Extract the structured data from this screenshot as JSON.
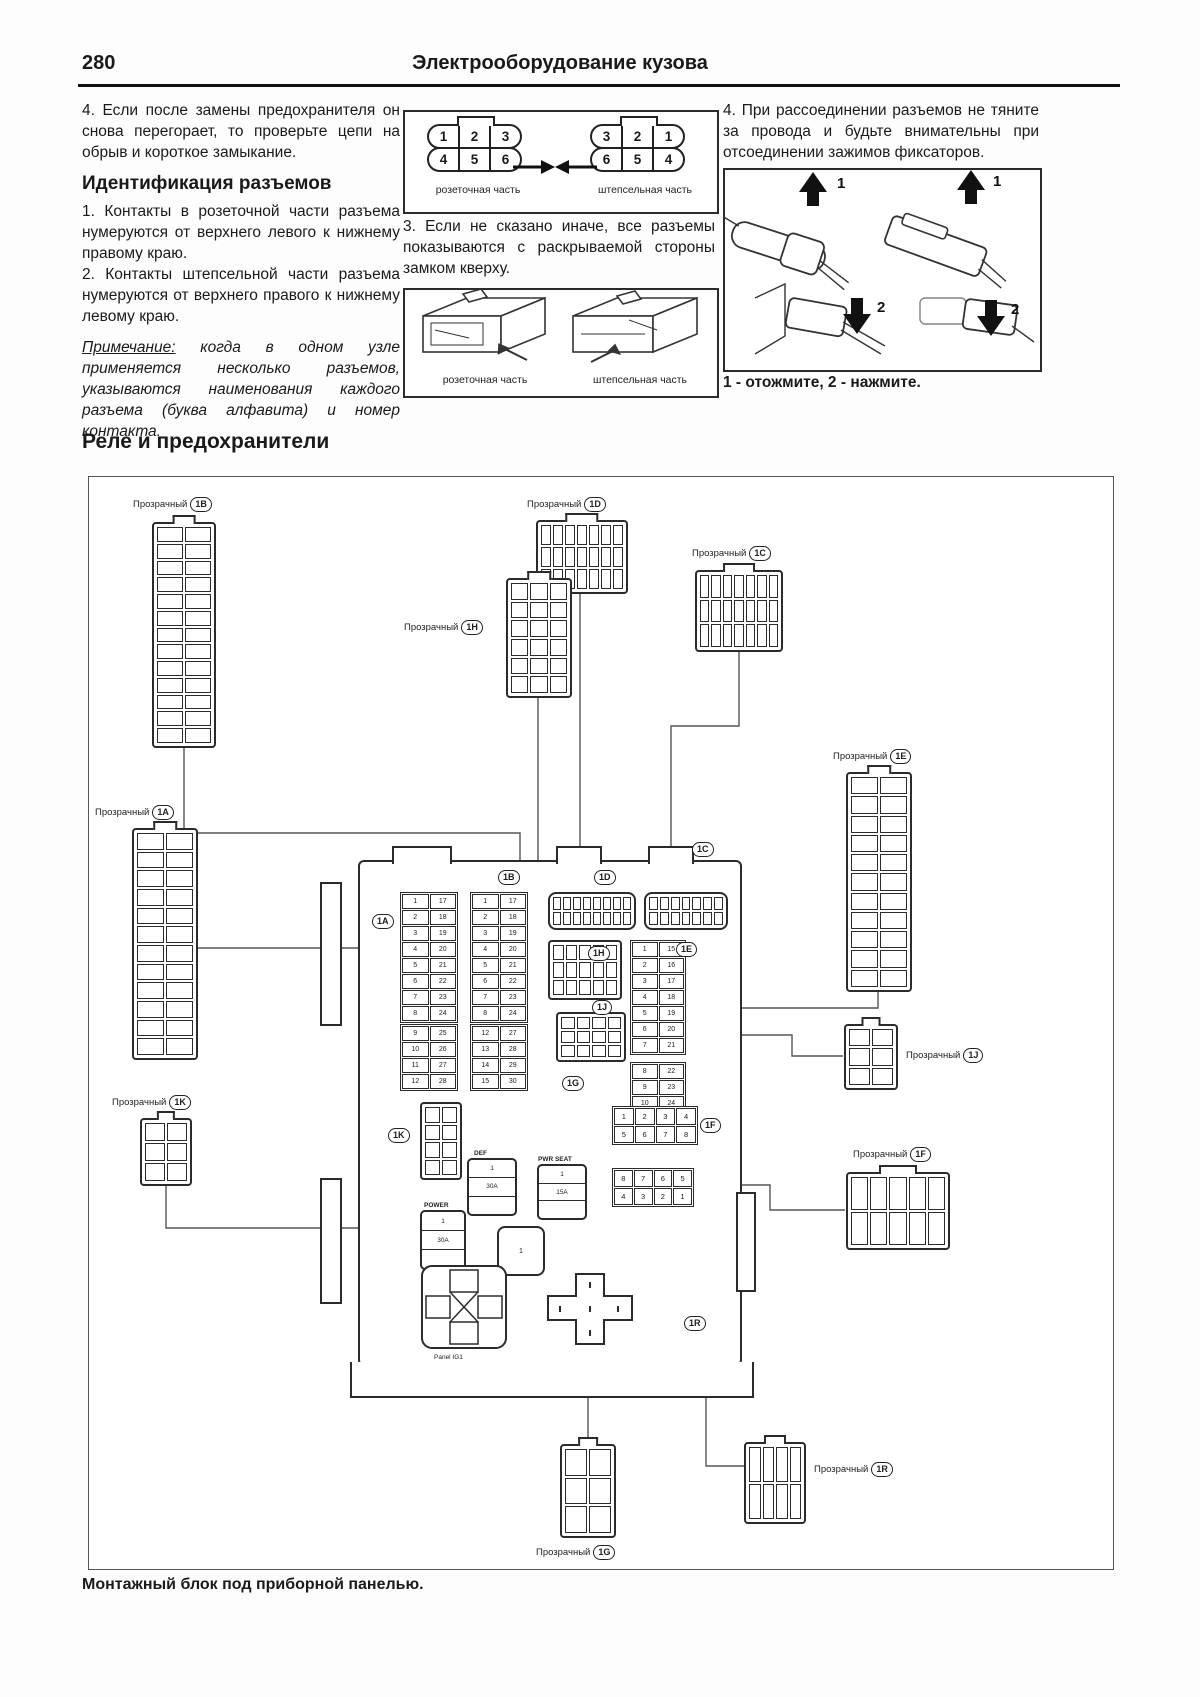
{
  "page": {
    "number": "280",
    "title": "Электрооборудование кузова"
  },
  "intro": {
    "item4_left": "4. Если после замены предохранителя он снова перегорает, то проверьте цепи на обрыв и короткое замыкание.",
    "heading": "Идентификация разъемов",
    "item1": "1. Контакты в розеточной части разъема нумеруются от верхнего левого к нижнему правому краю.",
    "item2": "2. Контакты штепсельной части разъема нумеруются от верхнего правого к нижнему левому краю.",
    "note_label": "Примечание:",
    "note_text": " когда в одном узле применяется несколько разъемов, указываются наименования каждого разъема (буква алфавита) и номер контакта.",
    "item3": "3. Если не сказано иначе, все разъемы показываются с раскрываемой стороны замком кверху.",
    "item4_right": "4. При рассоединении разъемов не тяните за провода и будьте внимательны при отсоединении зажимов фиксаторов.",
    "press_caption": "1 - отожмите, 2 - нажмите.",
    "arrow_labels": [
      "1",
      "1",
      "2",
      "2"
    ]
  },
  "pin_diagrams": {
    "socket_row1": [
      "1",
      "2",
      "3"
    ],
    "socket_row2": [
      "4",
      "5",
      "6"
    ],
    "plug_row1": [
      "3",
      "2",
      "1"
    ],
    "plug_row2": [
      "6",
      "5",
      "4"
    ],
    "socket_caption": "розеточная часть",
    "plug_caption": "штепсельная часть"
  },
  "relay": {
    "heading": "Реле и предохранители",
    "caption": "Монтажный блок под приборной панелью.",
    "transparent": "Прозрачный",
    "codes": {
      "a": "1A",
      "b": "1B",
      "c": "1C",
      "d": "1D",
      "e": "1E",
      "f": "1F",
      "g": "1G",
      "h": "1H",
      "j": "1J",
      "k": "1K",
      "r": "1R"
    },
    "panel_label": "Panel IG1",
    "relays": {
      "def": {
        "label": "DEF",
        "pin": "1",
        "amp": "30A"
      },
      "pwr_seat": {
        "label": "PWR SEAT",
        "pin": "1",
        "amp": "15A"
      },
      "power": {
        "label": "POWER",
        "pin": "1",
        "amp": "30A"
      },
      "castle_pin": "1"
    },
    "fuse_blocks": {
      "a1": [
        [
          "1",
          "17"
        ],
        [
          "2",
          "18"
        ],
        [
          "3",
          "19"
        ],
        [
          "4",
          "20"
        ],
        [
          "5",
          "21"
        ],
        [
          "6",
          "22"
        ],
        [
          "7",
          "23"
        ],
        [
          "8",
          "24"
        ]
      ],
      "a2": [
        [
          "9",
          "25"
        ],
        [
          "10",
          "26"
        ],
        [
          "11",
          "27"
        ],
        [
          "12",
          "28"
        ]
      ],
      "b1": [
        [
          "1",
          "17"
        ],
        [
          "2",
          "18"
        ],
        [
          "3",
          "19"
        ],
        [
          "4",
          "20"
        ],
        [
          "5",
          "21"
        ],
        [
          "6",
          "22"
        ],
        [
          "7",
          "23"
        ],
        [
          "8",
          "24"
        ]
      ],
      "b2": [
        [
          "12",
          "27"
        ],
        [
          "13",
          "28"
        ],
        [
          "14",
          "29"
        ],
        [
          "15",
          "30"
        ]
      ],
      "c1": [
        [
          "1",
          "15"
        ],
        [
          "2",
          "16"
        ],
        [
          "3",
          "17"
        ],
        [
          "4",
          "18"
        ],
        [
          "5",
          "19"
        ],
        [
          "6",
          "20"
        ],
        [
          "7",
          "21"
        ]
      ],
      "c2": [
        [
          "8",
          "22"
        ],
        [
          "9",
          "23"
        ],
        [
          "10",
          "24"
        ],
        [
          "11",
          "25"
        ]
      ]
    },
    "grids": {
      "f": [
        "1",
        "2",
        "3",
        "4",
        "5",
        "6",
        "7",
        "8"
      ],
      "r": [
        "8",
        "7",
        "6",
        "5",
        "4",
        "3",
        "2",
        "1"
      ]
    }
  }
}
